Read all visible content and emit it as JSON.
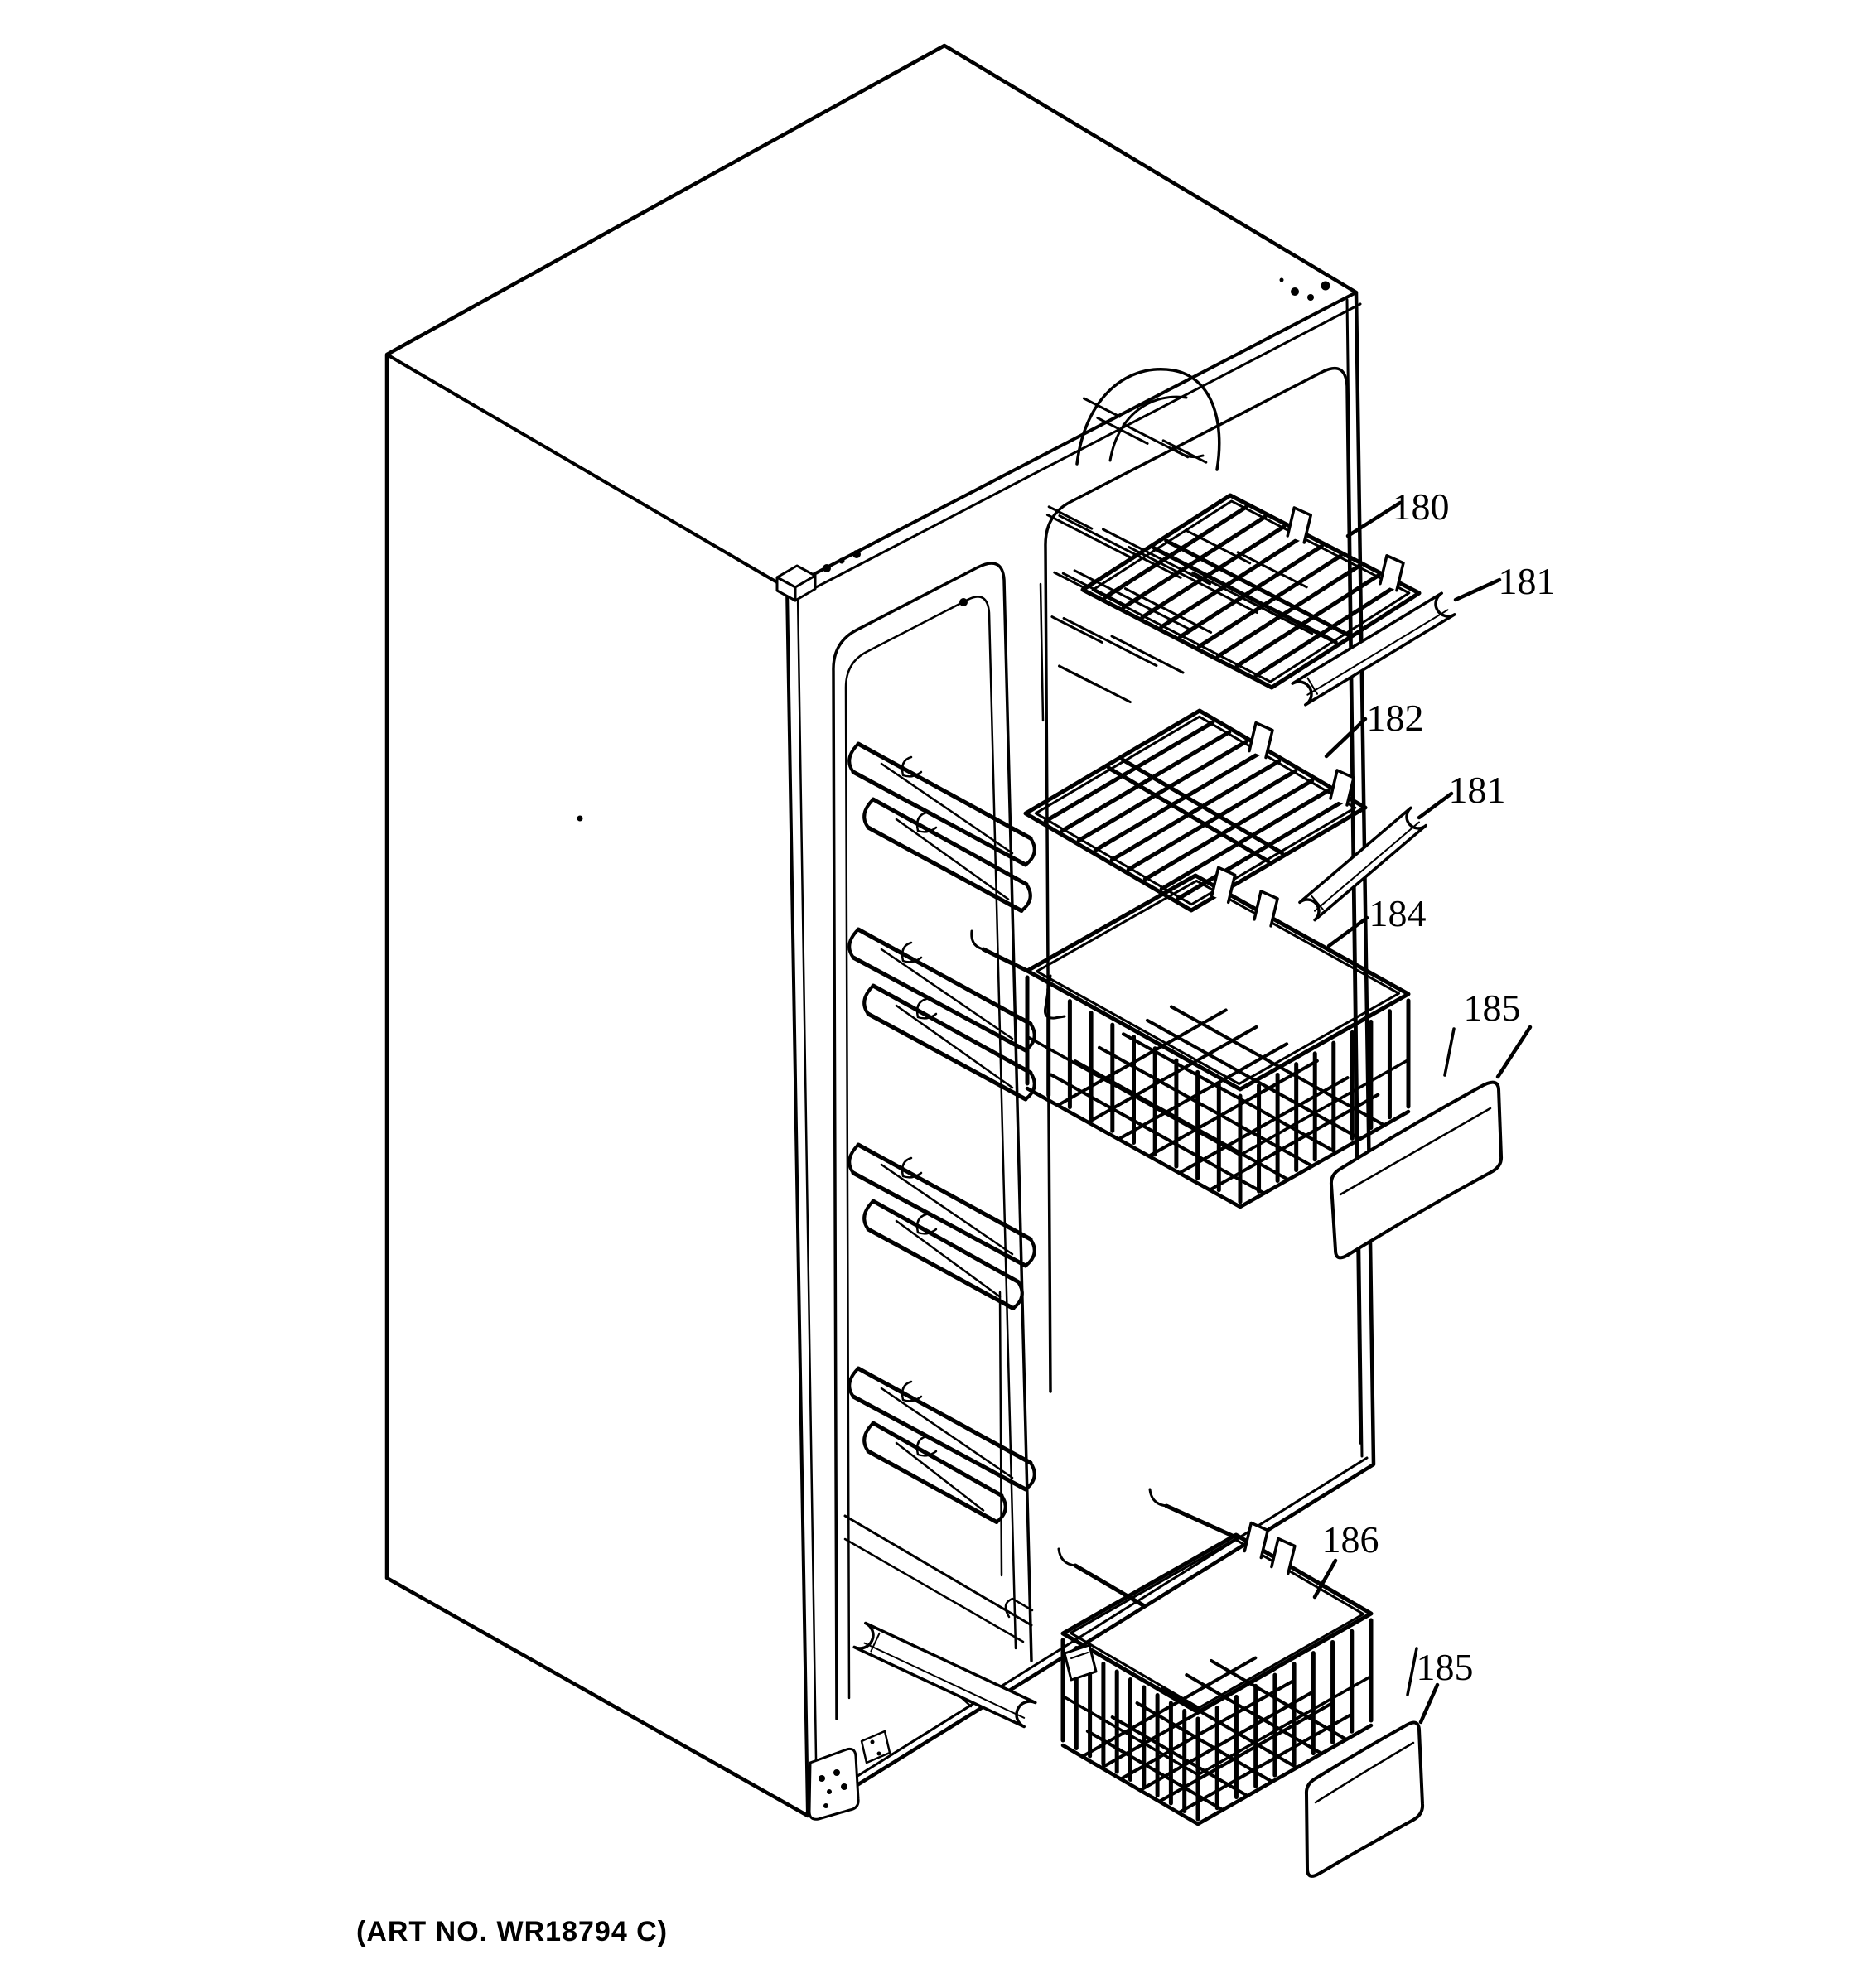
{
  "figure": {
    "kind": "exploded-parts-line-drawing",
    "subject": "refrigerator freezer compartment cabinet with exploded shelves, baskets and drawer fronts",
    "ink_color": "#000000",
    "paper_color": "#ffffff"
  },
  "art_no": "(ART NO. WR18794 C)",
  "callouts": [
    {
      "id": "callout-180",
      "label": "180",
      "part": "wire shelf (upper)"
    },
    {
      "id": "callout-181-upper",
      "label": "181",
      "part": "shelf trim rail (upper)"
    },
    {
      "id": "callout-182",
      "label": "182",
      "part": "wire shelf (lower)"
    },
    {
      "id": "callout-181-lower",
      "label": "181",
      "part": "shelf trim rail (lower)"
    },
    {
      "id": "callout-184",
      "label": "184",
      "part": "slide-out wire basket (upper)"
    },
    {
      "id": "callout-185-upper",
      "label": "185",
      "part": "basket drawer front (upper)"
    },
    {
      "id": "callout-186",
      "label": "186",
      "part": "slide-out wire basket (lower)"
    },
    {
      "id": "callout-185-lower",
      "label": "185",
      "part": "basket drawer front (lower)"
    }
  ]
}
